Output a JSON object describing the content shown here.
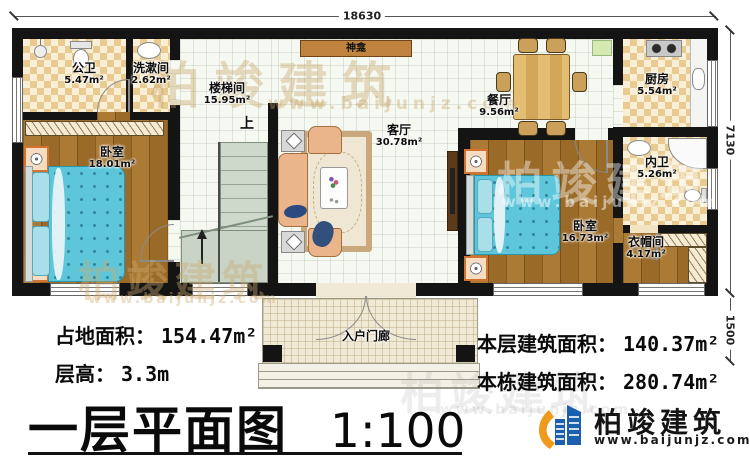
{
  "title": {
    "main": "一层平面图",
    "scale": "1:100"
  },
  "dimensions": {
    "width_top": "18630",
    "height_right": "7130",
    "porch_right": "1500"
  },
  "rooms": {
    "public_bath": {
      "name": "公卫",
      "area": "5.47m²"
    },
    "washroom": {
      "name": "洗漱间",
      "area": "2.62m²"
    },
    "stairwell": {
      "name": "楼梯间",
      "area": "15.95m²"
    },
    "shrine": {
      "name": "神龛"
    },
    "living": {
      "name": "客厅",
      "area": "30.78m²"
    },
    "dining": {
      "name": "餐厅",
      "area": "9.56m²"
    },
    "kitchen": {
      "name": "厨房",
      "area": "5.54m²"
    },
    "ensuite_bath": {
      "name": "内卫",
      "area": "5.26m²"
    },
    "bedroom_left": {
      "name": "卧室",
      "area": "18.01m²"
    },
    "bedroom_right": {
      "name": "卧室",
      "area": "16.73m²"
    },
    "closet": {
      "name": "衣帽间",
      "area": "4.17m²"
    },
    "porch": {
      "name": "入户门廊"
    },
    "stair_direction": "上"
  },
  "stats": {
    "land_area": {
      "label": "占地面积：",
      "value": "154.47m²"
    },
    "floor_height": {
      "label": "层高：",
      "value": "3.3m"
    },
    "floor_area": {
      "label": "本层建筑面积：",
      "value": "140.37m²"
    },
    "building_area": {
      "label": "本栋建筑面积：",
      "value": "280.74m²"
    }
  },
  "brand": {
    "name": "柏竣建筑",
    "url": "www.baijunjz.com"
  },
  "watermark": {
    "text": "柏竣建筑",
    "url": "www.baijunjz.com"
  },
  "colors": {
    "wall": "#141414",
    "tile_tan": "#e9cb92",
    "wood": "#a5752f",
    "bed_blue": "#5ec6da",
    "brand_blue": "#1b5fae",
    "brand_orange": "#f09a1c"
  }
}
